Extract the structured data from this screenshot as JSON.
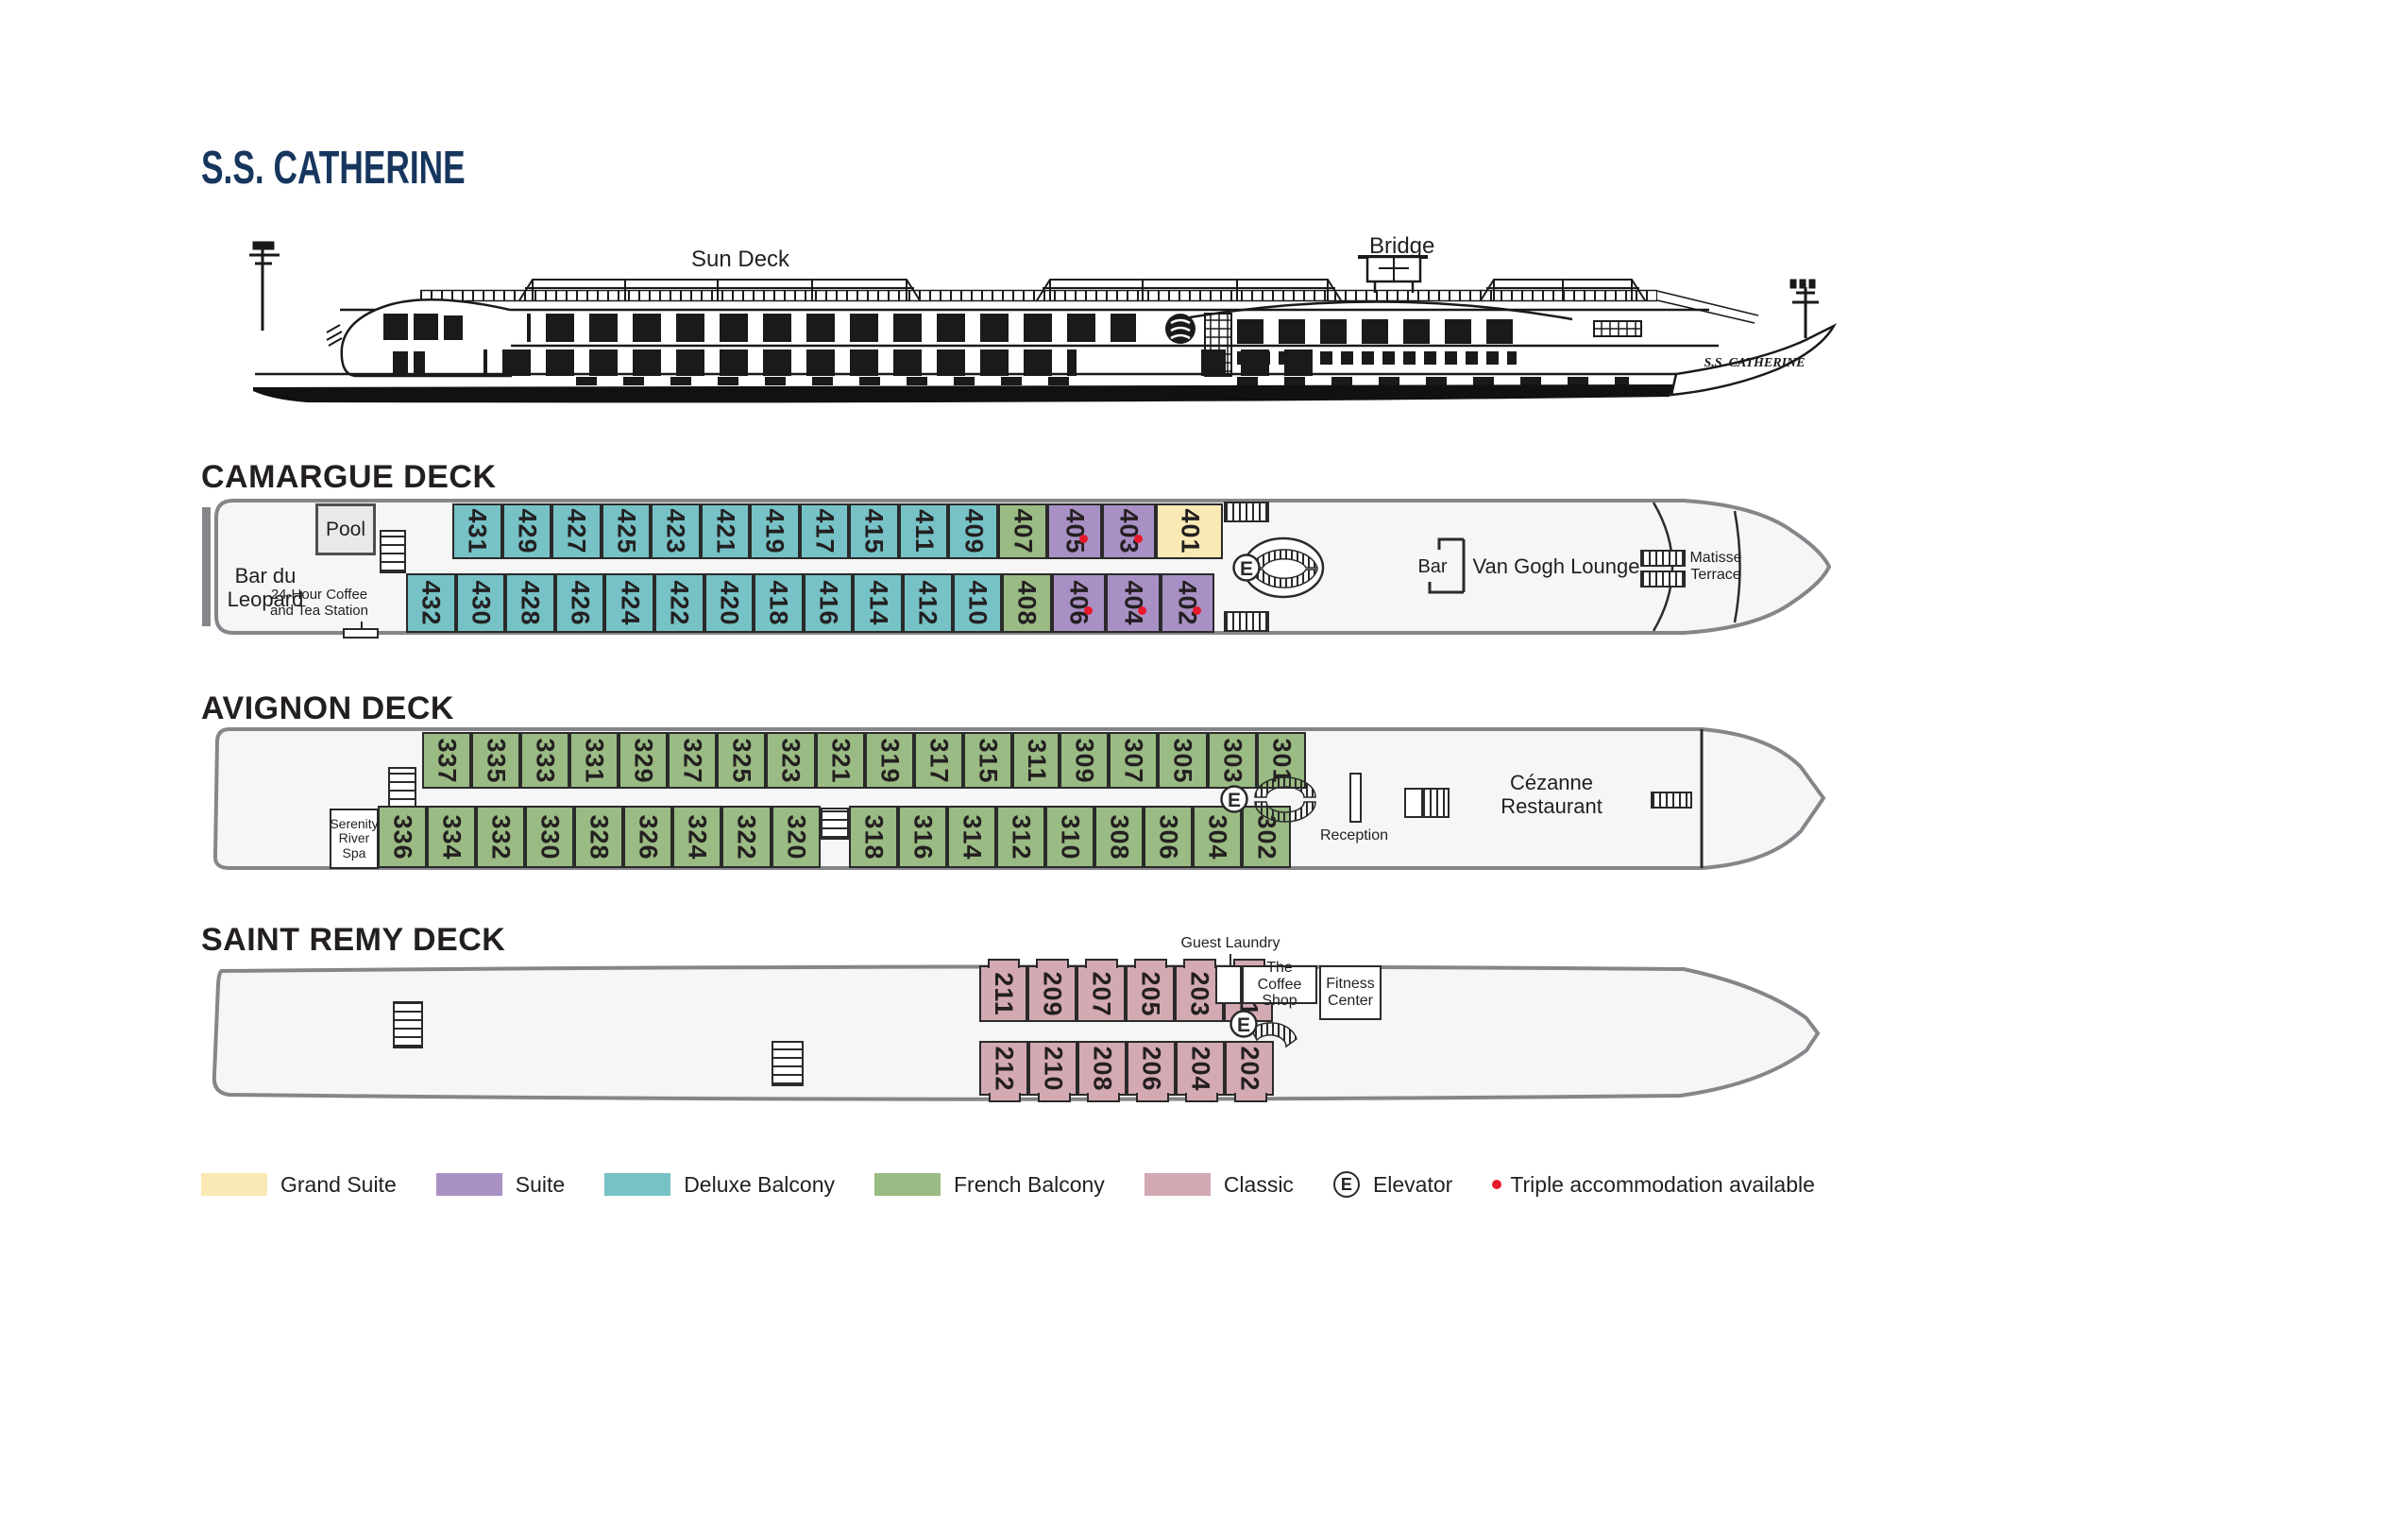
{
  "title": "S.S. CATHERINE",
  "profile": {
    "sun_deck": "Sun Deck",
    "bridge": "Bridge",
    "name_on_bow": "S.S. CATHERINE"
  },
  "categories": {
    "grand": {
      "label": "Grand Suite",
      "color": "#fae9b4"
    },
    "suite": {
      "label": "Suite",
      "color": "#a890c4"
    },
    "deluxe": {
      "label": "Deluxe Balcony",
      "color": "#76c2c6"
    },
    "french": {
      "label": "French Balcony",
      "color": "#9abb83"
    },
    "classic": {
      "label": "Classic",
      "color": "#d3a9b2"
    }
  },
  "legend": {
    "order": [
      "grand",
      "suite",
      "deluxe",
      "french",
      "classic"
    ],
    "elevator_letter": "E",
    "elevator_label": "Elevator",
    "triple_label": "Triple accommodation available"
  },
  "decks": {
    "camargue": {
      "name": "CAMARGUE DECK",
      "venues": {
        "bar": [
          "Bar du",
          "Leopard"
        ],
        "pool": "Pool",
        "coffee": [
          "24-Hour Coffee",
          "and Tea Station"
        ],
        "bar_counter": "Bar",
        "lounge": "Van Gogh Lounge",
        "terrace": [
          "Matisse",
          "Terrace"
        ],
        "elevator_letter": "E"
      },
      "rows": {
        "top": [
          {
            "n": "431",
            "t": "deluxe"
          },
          {
            "n": "429",
            "t": "deluxe"
          },
          {
            "n": "427",
            "t": "deluxe"
          },
          {
            "n": "425",
            "t": "deluxe"
          },
          {
            "n": "423",
            "t": "deluxe"
          },
          {
            "n": "421",
            "t": "deluxe"
          },
          {
            "n": "419",
            "t": "deluxe"
          },
          {
            "n": "417",
            "t": "deluxe"
          },
          {
            "n": "415",
            "t": "deluxe"
          },
          {
            "n": "411",
            "t": "deluxe"
          },
          {
            "n": "409",
            "t": "deluxe"
          },
          {
            "n": "407",
            "t": "french"
          },
          {
            "n": "405",
            "t": "suite",
            "dot": true,
            "w": 1.1
          },
          {
            "n": "403",
            "t": "suite",
            "dot": true,
            "w": 1.1
          },
          {
            "n": "401",
            "t": "grand",
            "w": 1.38
          }
        ],
        "bottom": [
          {
            "n": "432",
            "t": "deluxe"
          },
          {
            "n": "430",
            "t": "deluxe"
          },
          {
            "n": "428",
            "t": "deluxe"
          },
          {
            "n": "426",
            "t": "deluxe"
          },
          {
            "n": "424",
            "t": "deluxe"
          },
          {
            "n": "422",
            "t": "deluxe"
          },
          {
            "n": "420",
            "t": "deluxe"
          },
          {
            "n": "418",
            "t": "deluxe"
          },
          {
            "n": "416",
            "t": "deluxe"
          },
          {
            "n": "414",
            "t": "deluxe"
          },
          {
            "n": "412",
            "t": "deluxe"
          },
          {
            "n": "410",
            "t": "deluxe"
          },
          {
            "n": "408",
            "t": "french"
          },
          {
            "n": "406",
            "t": "suite",
            "dot": true,
            "w": 1.1
          },
          {
            "n": "404",
            "t": "suite",
            "dot": true,
            "w": 1.1
          },
          {
            "n": "402",
            "t": "suite",
            "dot": true,
            "w": 1.1
          }
        ]
      }
    },
    "avignon": {
      "name": "AVIGNON DECK",
      "venues": {
        "spa": [
          "Serenity",
          "River",
          "Spa"
        ],
        "reception": "Reception",
        "restaurant": [
          "Cézanne",
          "Restaurant"
        ],
        "elevator_letter": "E"
      },
      "rows": {
        "top": [
          {
            "n": "337",
            "t": "french"
          },
          {
            "n": "335",
            "t": "french"
          },
          {
            "n": "333",
            "t": "french"
          },
          {
            "n": "331",
            "t": "french"
          },
          {
            "n": "329",
            "t": "french"
          },
          {
            "n": "327",
            "t": "french"
          },
          {
            "n": "325",
            "t": "french"
          },
          {
            "n": "323",
            "t": "french"
          },
          {
            "n": "321",
            "t": "french"
          },
          {
            "n": "319",
            "t": "french"
          },
          {
            "n": "317",
            "t": "french"
          },
          {
            "n": "315",
            "t": "french"
          },
          {
            "n": "311",
            "t": "french"
          },
          {
            "n": "309",
            "t": "french"
          },
          {
            "n": "307",
            "t": "french"
          },
          {
            "n": "305",
            "t": "french"
          },
          {
            "n": "303",
            "t": "french"
          },
          {
            "n": "301",
            "t": "french"
          }
        ],
        "bottom": [
          {
            "n": "336",
            "t": "french"
          },
          {
            "n": "334",
            "t": "french"
          },
          {
            "n": "332",
            "t": "french"
          },
          {
            "n": "330",
            "t": "french"
          },
          {
            "n": "328",
            "t": "french"
          },
          {
            "n": "326",
            "t": "french"
          },
          {
            "n": "324",
            "t": "french"
          },
          {
            "n": "322",
            "t": "french"
          },
          {
            "n": "320",
            "t": "french"
          },
          {
            "gap": true,
            "stairs": true
          },
          {
            "n": "318",
            "t": "french"
          },
          {
            "n": "316",
            "t": "french"
          },
          {
            "n": "314",
            "t": "french"
          },
          {
            "n": "312",
            "t": "french"
          },
          {
            "n": "310",
            "t": "french"
          },
          {
            "n": "308",
            "t": "french"
          },
          {
            "n": "306",
            "t": "french"
          },
          {
            "n": "304",
            "t": "french"
          },
          {
            "n": "302",
            "t": "french"
          }
        ]
      }
    },
    "saintremy": {
      "name": "SAINT REMY DECK",
      "venues": {
        "laundry": "Guest Laundry",
        "coffee_shop": [
          "The Coffee",
          "Shop"
        ],
        "fitness": [
          "Fitness",
          "Center"
        ],
        "elevator_letter": "E"
      },
      "rows": {
        "top": [
          {
            "n": "211",
            "t": "classic"
          },
          {
            "n": "209",
            "t": "classic"
          },
          {
            "n": "207",
            "t": "classic"
          },
          {
            "n": "205",
            "t": "classic"
          },
          {
            "n": "203",
            "t": "classic"
          },
          {
            "n": "201",
            "t": "classic"
          }
        ],
        "bottom": [
          {
            "n": "212",
            "t": "classic"
          },
          {
            "n": "210",
            "t": "classic"
          },
          {
            "n": "208",
            "t": "classic"
          },
          {
            "n": "206",
            "t": "classic"
          },
          {
            "n": "204",
            "t": "classic"
          },
          {
            "n": "202",
            "t": "classic"
          }
        ]
      }
    }
  }
}
